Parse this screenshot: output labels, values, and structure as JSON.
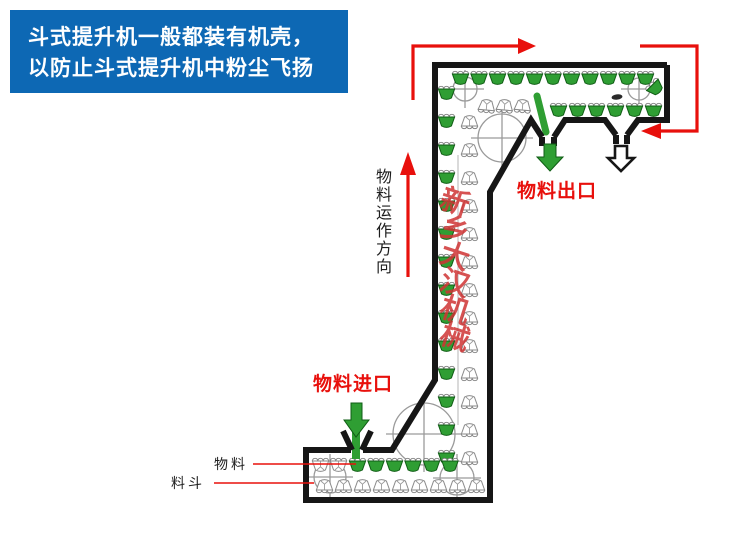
{
  "banner": {
    "line1": "斗式提升机一般都装有机壳，",
    "line2": "以防止斗式提升机中粉尘飞扬"
  },
  "labels": {
    "outlet": "物料出口",
    "inlet": "物料进口",
    "material": "物料",
    "bucket": "料斗",
    "flow_direction": "物料运作方向",
    "watermark_chars": [
      "新",
      "乡",
      "大",
      "汉",
      "机",
      "械"
    ]
  },
  "colors": {
    "banner_blue": "#0d68b4",
    "arrow_red": "#e8100c",
    "bucket_green": "#2f9e33",
    "bucket_green_dark": "#0f5c14",
    "casing_outline": "#161616",
    "pulley_gray": "#9a9a9a",
    "watermark_red": "#cf3434"
  },
  "diagram": {
    "bucket_rows": [
      {
        "kind": "full",
        "x": 452,
        "y": 69,
        "dx": 18.5,
        "n": 11
      },
      {
        "kind": "full",
        "x": 646,
        "y": 79,
        "n": 1,
        "rot": -45
      },
      {
        "kind": "empty",
        "x": 478,
        "y": 99,
        "dx": 18,
        "n": 3,
        "rot": 185
      },
      {
        "kind": "full",
        "x": 550,
        "y": 101,
        "dx": 19,
        "n": 6
      },
      {
        "kind": "full",
        "x": 438,
        "y": 84,
        "dy": 28,
        "n": 14
      },
      {
        "kind": "empty",
        "x": 461,
        "y": 115,
        "dy": 28,
        "n": 13,
        "rot": 180
      },
      {
        "kind": "empty",
        "x": 312,
        "y": 456,
        "dx": 18,
        "n": 2
      },
      {
        "kind": "full",
        "x": 349,
        "y": 456,
        "dx": 18.5,
        "n": 6
      },
      {
        "kind": "empty",
        "x": 316,
        "y": 479,
        "dx": 19,
        "n": 9,
        "rot": 180
      }
    ],
    "pulleys": [
      {
        "cx": 465,
        "cy": 89,
        "r": 12
      },
      {
        "cx": 639,
        "cy": 89,
        "r": 11
      },
      {
        "cx": 502,
        "cy": 138,
        "r": 24
      },
      {
        "cx": 424,
        "cy": 434,
        "r": 31
      },
      {
        "cx": 330,
        "cy": 477,
        "r": 16
      },
      {
        "cx": 457,
        "cy": 478,
        "r": 17
      }
    ]
  }
}
